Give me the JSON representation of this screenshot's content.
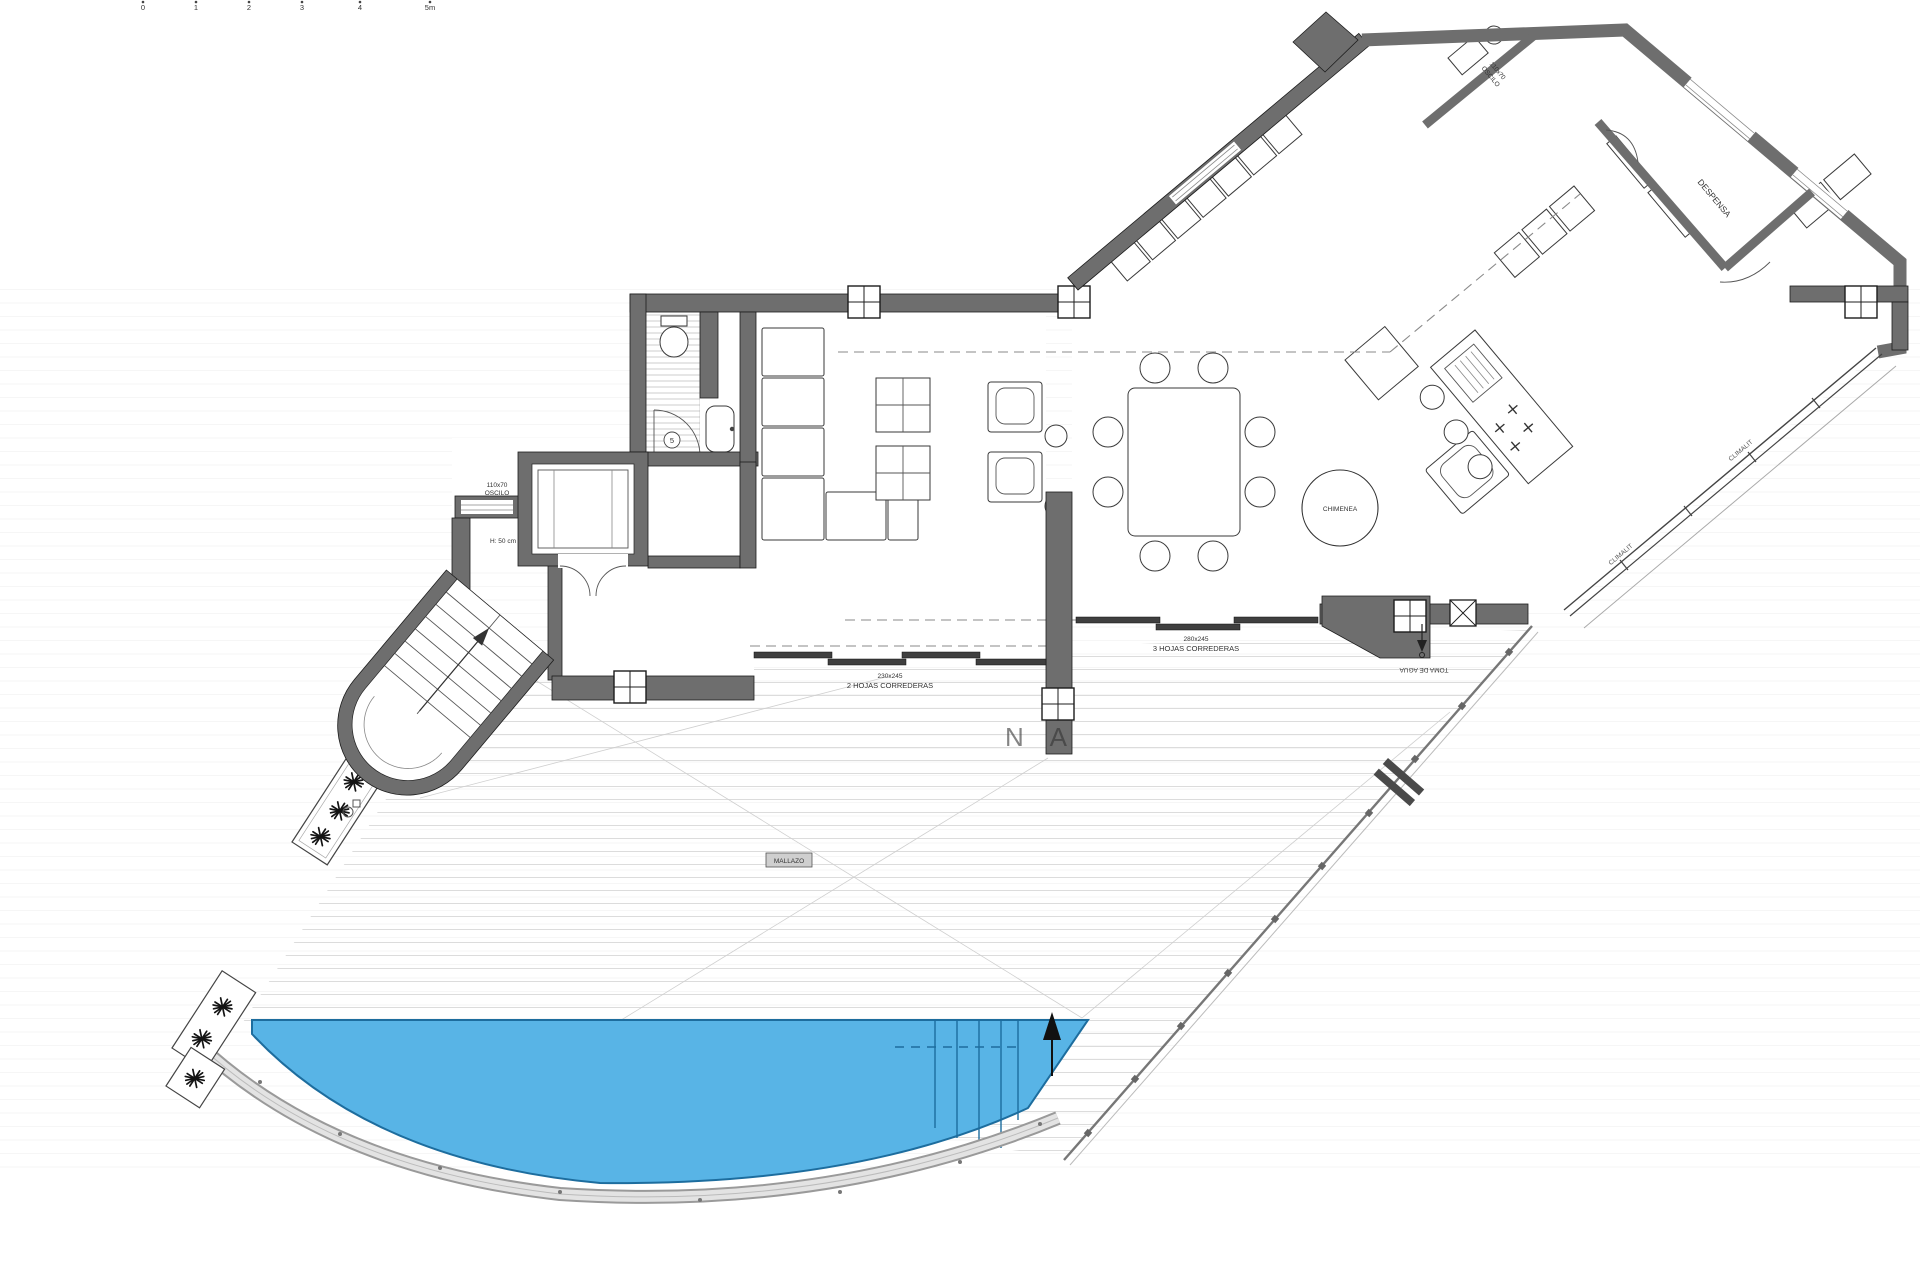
{
  "scale_bar": {
    "labels": [
      "0",
      "1",
      "2",
      "3",
      "4",
      "5m"
    ]
  },
  "labels": {
    "lift_window_line1": "110x70",
    "lift_window_line2": "OSCILO",
    "lift_height": "H: 50 cm",
    "door_number": "5",
    "fireplace": "CHIMENEA",
    "slider2_size": "230x245",
    "slider2_name": "2 HOJAS CORREDERAS",
    "slider3_size": "280x245",
    "slider3_name": "3 HOJAS CORREDERAS",
    "water_tap": "TOMA DE AGUA",
    "mesh_tag": "MALLAZO",
    "pantry": "DESPENSA",
    "wing_window_line1": "110x70",
    "wing_window_line2": "OSCILO",
    "glass_label_upper": "CLIMALIT",
    "glass_label_lower": "CLIMALIT",
    "watermark": "N A"
  },
  "colors": {
    "wall": "#6e6e6e",
    "pool_fill": "#58b4e6",
    "pool_edge": "#1d6d9e",
    "deck_line": "#dcdcdc"
  }
}
